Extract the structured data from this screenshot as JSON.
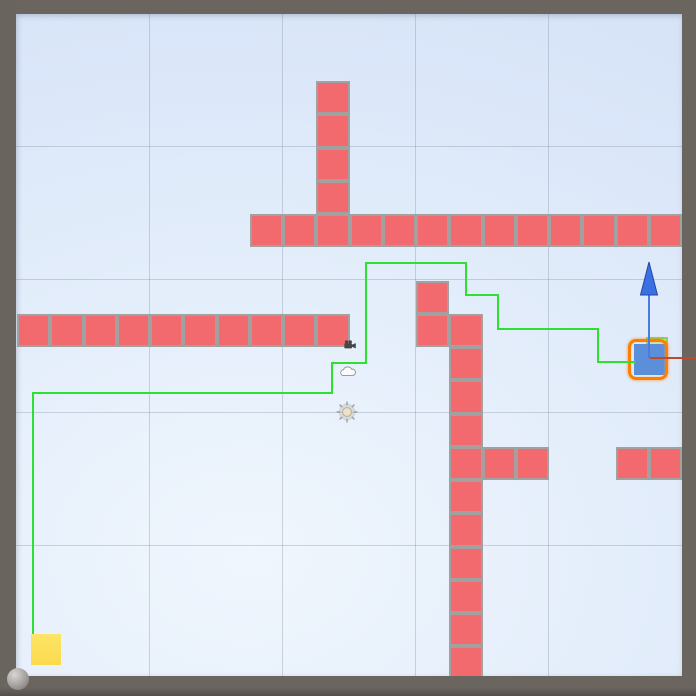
{
  "app": {
    "view_name": "scene-view"
  },
  "frame": {
    "color": "#6b6560",
    "top": 14,
    "left": 16,
    "right_x": 682,
    "bottom_y": 676
  },
  "scene": {
    "bg_center": "#f0f6fd",
    "bg_mid": "#e4eefb",
    "bg_edge": "#d7e4f8",
    "grid": {
      "color": "rgba(125,138,156,0.33)",
      "vertical_x": [
        149,
        282,
        415,
        548
      ],
      "horizontal_y": [
        146,
        279,
        412,
        545
      ]
    }
  },
  "chart_data": {
    "type": "heatmap",
    "title": "",
    "note": "tile map occupancy; tiles listed as [col,row] on a 33.25px grid with origin at page (17,14.5)",
    "tiles": [
      [
        7,
        6
      ],
      [
        8,
        6
      ],
      [
        9,
        6
      ],
      [
        10,
        6
      ],
      [
        11,
        6
      ],
      [
        12,
        6
      ],
      [
        13,
        6
      ],
      [
        14,
        6
      ],
      [
        15,
        6
      ],
      [
        16,
        6
      ],
      [
        17,
        6
      ],
      [
        18,
        6
      ],
      [
        19,
        6
      ],
      [
        9,
        2
      ],
      [
        9,
        3
      ],
      [
        9,
        4
      ],
      [
        9,
        5
      ],
      [
        0,
        9
      ],
      [
        1,
        9
      ],
      [
        2,
        9
      ],
      [
        3,
        9
      ],
      [
        4,
        9
      ],
      [
        5,
        9
      ],
      [
        6,
        9
      ],
      [
        7,
        9
      ],
      [
        8,
        9
      ],
      [
        9,
        9
      ],
      [
        12,
        8
      ],
      [
        12,
        9
      ],
      [
        13,
        9
      ],
      [
        13,
        10
      ],
      [
        13,
        11
      ],
      [
        13,
        12
      ],
      [
        13,
        13
      ],
      [
        13,
        14
      ],
      [
        13,
        15
      ],
      [
        13,
        16
      ],
      [
        13,
        17
      ],
      [
        13,
        18
      ],
      [
        13,
        19
      ],
      [
        14,
        13
      ],
      [
        15,
        13
      ],
      [
        18,
        13
      ],
      [
        19,
        13
      ]
    ]
  },
  "tilemap": {
    "tile_size": 33.25,
    "origin_x": 17,
    "origin_y": 14.5,
    "fill": "#f2696e",
    "border_color": "#a1a1a1",
    "border_width": 2.5
  },
  "path": {
    "color": "#2fe12f",
    "width": 2,
    "points": [
      [
        33,
        634
      ],
      [
        33,
        393
      ],
      [
        332,
        393
      ],
      [
        332,
        363
      ],
      [
        366,
        363
      ],
      [
        366,
        263
      ],
      [
        466,
        263
      ],
      [
        466,
        295
      ],
      [
        498,
        295
      ],
      [
        498,
        329
      ],
      [
        598,
        329
      ],
      [
        598,
        362
      ],
      [
        636,
        362
      ]
    ]
  },
  "goal": {
    "x": 31,
    "y": 634,
    "width": 30,
    "height": 31,
    "color_top": "#fde566",
    "color_bottom": "#fbda4e"
  },
  "player": {
    "x": 634,
    "y": 344,
    "width": 31,
    "height": 31,
    "color": "#5c8fd9"
  },
  "selection": {
    "x": 628,
    "y": 339,
    "width": 40,
    "height": 41,
    "color": "#ff7d00"
  },
  "ghost": {
    "x": 646,
    "y": 337,
    "width": 22,
    "height": 21,
    "fill": "rgba(163,228,133,0.5)",
    "border": "rgba(105,213,66,0.75)"
  },
  "gizmo": {
    "origin": [
      649,
      358
    ],
    "y_axis": {
      "shaft_color": "#4b7ae0",
      "head_fill": "#3b6fe4",
      "head_stroke": "#27479e",
      "tip": [
        649,
        262
      ],
      "base_y": 295,
      "half_width": 8.5
    },
    "x_axis": {
      "color": "#c0482c",
      "end_x": 696
    }
  },
  "icons": {
    "camera": {
      "x": 344,
      "y": 340
    },
    "cloud": {
      "x": 339,
      "y": 365
    },
    "light": {
      "x": 347,
      "y": 412
    }
  },
  "sphere": {
    "cx": 18,
    "cy": 679,
    "r": 11
  }
}
